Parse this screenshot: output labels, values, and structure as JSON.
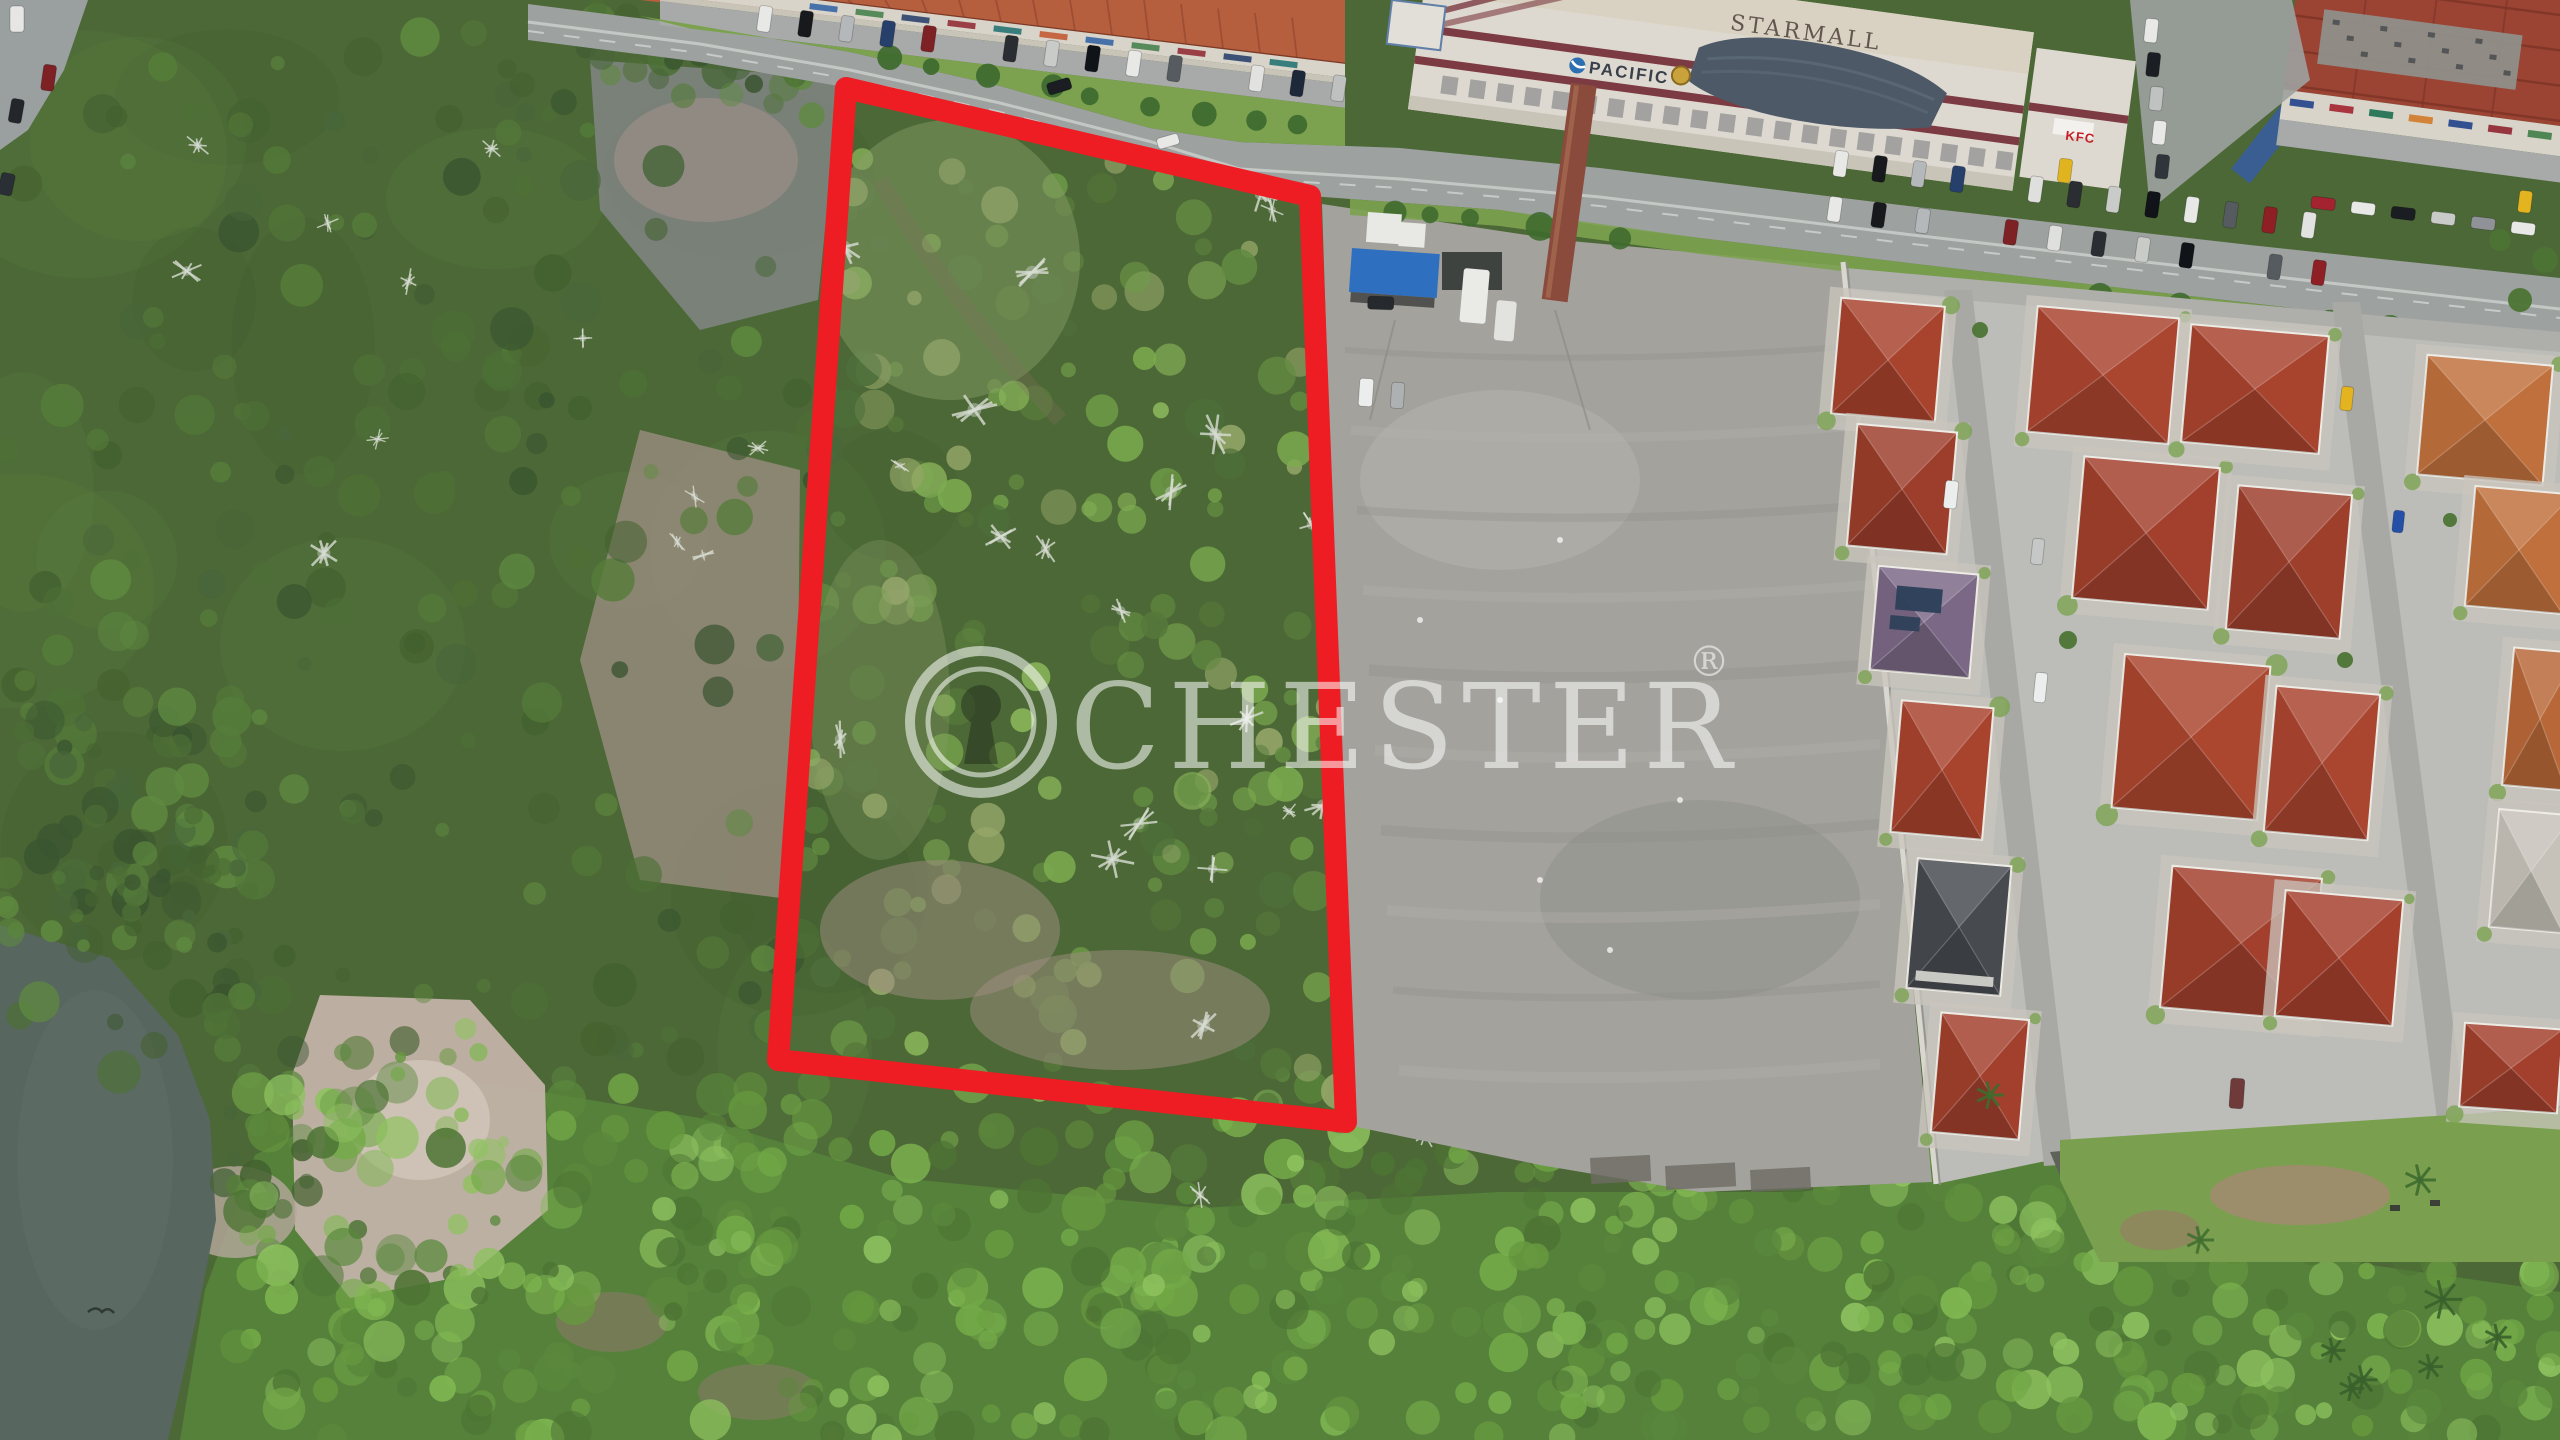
{
  "meta": {
    "title": "aerial-drone-land-parcel-photo",
    "canvas": {
      "width": 2560,
      "height": 1440
    }
  },
  "watermark": {
    "brand": "CHESTER",
    "registered_mark": "®",
    "logo": "keyhole-icon",
    "color": "#ffffff",
    "opacity": 0.55
  },
  "signage": {
    "mall_roof_sign": "STARMALL",
    "mall_facade_sign": "PACIFIC",
    "fastfood_sign": "KFC"
  },
  "boundary_overlay": {
    "color": "#ee1d23",
    "stroke_width": 22,
    "points": "846,88 1310,196 1346,1122 778,1060"
  },
  "palette": {
    "base_forest": "#4c6836",
    "road": "#9da1a0",
    "road_line": "#d2d5d2",
    "guardrail": "#c9ccc9",
    "pavement": "#9aa09f",
    "lot": "#a3a29d",
    "lot_light": "#b5b3ad",
    "lot_dark": "#908f89",
    "shop_roof": "#b65f3f",
    "shop_facade": "#d9d4c9",
    "walkway": "#c9c4b8",
    "parking": "#a7aaa9",
    "grass": "#7ca24f",
    "mall_white": "#ded9d0",
    "mall_cream": "#d9d2c2",
    "maroon": "#7c3b42",
    "canopy": "#4d5966",
    "brick": "#8a4a3c",
    "red_roof_block": "#9c4434",
    "estate_ground": "#bcbdb8",
    "street": "#a8a9a5",
    "asphalt_dark": "#5f6259",
    "wall": "#d9d7d0",
    "water": "#57665e",
    "pad": "#c9c6bd"
  },
  "scene": {
    "tree_palettes": {
      "dark": [
        "#3a5530",
        "#43612f",
        "#4d7036",
        "#557c3a",
        "#5f8a40",
        "#48663a"
      ],
      "bright": [
        "#4d7434",
        "#5a883c",
        "#67993f",
        "#74aa48",
        "#81b852",
        "#8ec25f"
      ],
      "parcel": [
        "#56793b",
        "#628b41",
        "#6f9d48",
        "#7cab4f",
        "#8ab65a",
        "#4d6e3a",
        "#97a86a"
      ]
    },
    "zones": [
      {
        "name": "rock-clearing-upper",
        "type": "poly",
        "points": "590,60 840,78 818,300 700,330 600,210",
        "fill": "#85878a",
        "opacity": 0.8
      },
      {
        "name": "rock-tint",
        "type": "ellipse",
        "cx": 706,
        "cy": 160,
        "rx": 92,
        "ry": 62,
        "fill": "#a5918a",
        "opacity": 0.55
      },
      {
        "name": "red-soil-clearing",
        "type": "poly",
        "points": "640,430 800,470 796,900 640,880 580,660",
        "fill": "#a5928a",
        "opacity": 0.7
      },
      {
        "name": "bottom-forest",
        "type": "poly",
        "points": "180,1440 205,1290 255,1155 420,1072 700,1118 900,1178 1200,1208 1500,1192 1800,1192 2050,1158 2200,1212 2350,1262 2560,1292 2560,1440",
        "fill": "#55813a",
        "opacity": 1
      },
      {
        "name": "pink-soil-clearing",
        "type": "poly",
        "points": "320,995 470,1000 545,1085 548,1210 470,1275 350,1298 295,1230 292,1075",
        "fill": "#c2b2a8",
        "opacity": 0.95
      },
      {
        "name": "pink-soil-light",
        "type": "ellipse",
        "cx": 420,
        "cy": 1120,
        "rx": 70,
        "ry": 60,
        "fill": "#d2c6bc",
        "opacity": 0.8
      },
      {
        "name": "pink-soil-secondary",
        "type": "ellipse",
        "cx": 235,
        "cy": 1212,
        "rx": 62,
        "ry": 46,
        "fill": "#b7a79d",
        "opacity": 0.8
      },
      {
        "name": "brown-patch-1",
        "type": "ellipse",
        "cx": 612,
        "cy": 1322,
        "rx": 56,
        "ry": 30,
        "fill": "#8b7a68",
        "opacity": 0.6
      },
      {
        "name": "brown-patch-2",
        "type": "ellipse",
        "cx": 758,
        "cy": 1392,
        "rx": 60,
        "ry": 28,
        "fill": "#8b7a68",
        "opacity": 0.55
      },
      {
        "name": "river",
        "type": "poly",
        "points": "0,925 110,958 178,1035 210,1120 216,1220 196,1320 168,1440 0,1440",
        "fill": "#57665e",
        "opacity": 1
      },
      {
        "name": "river-sheen",
        "type": "ellipse",
        "cx": 95,
        "cy": 1160,
        "rx": 78,
        "ry": 170,
        "fill": "#5f6e66",
        "opacity": 0.5
      }
    ],
    "scatter": [
      {
        "rect": [
          0,
          0,
          830,
          1080
        ],
        "count": 240,
        "palette": "dark",
        "rmin": 7,
        "rmax": 22,
        "avoid": true
      },
      {
        "rect": [
          500,
          0,
          330,
          120
        ],
        "count": 40,
        "palette": "dark",
        "rmin": 6,
        "rmax": 16
      },
      {
        "rect": [
          0,
          680,
          260,
          260
        ],
        "count": 60,
        "palette": "dark",
        "rmin": 7,
        "rmax": 20
      },
      {
        "rect": [
          40,
          866,
          220,
          80
        ],
        "count": 22,
        "palette": "dark",
        "rmin": 6,
        "rmax": 14
      },
      {
        "rect": [
          212,
          950,
          100,
          340
        ],
        "count": 30,
        "palette": "dark",
        "rmin": 7,
        "rmax": 16
      },
      {
        "rect": [
          300,
          1000,
          250,
          290
        ],
        "count": 14,
        "palette": "bright",
        "rmin": 5,
        "rmax": 11
      },
      {
        "rect": [
          230,
          1080,
          1120,
          360
        ],
        "count": 300,
        "palette": "bright",
        "rmin": 8,
        "rmax": 22
      },
      {
        "rect": [
          1350,
          1150,
          710,
          290
        ],
        "count": 160,
        "palette": "bright",
        "rmin": 8,
        "rmax": 20
      },
      {
        "rect": [
          2060,
          1250,
          500,
          190
        ],
        "count": 90,
        "palette": "bright",
        "rmin": 8,
        "rmax": 20
      },
      {
        "rect": [
          800,
          95,
          545,
          1030
        ],
        "count": 230,
        "palette": "parcel",
        "rmin": 7,
        "rmax": 20,
        "clip": true
      }
    ],
    "parcel_patches": [
      {
        "type": "ellipse",
        "cx": 950,
        "cy": 260,
        "rx": 130,
        "ry": 140,
        "fill": "#8aa06a",
        "opacity": 0.45
      },
      {
        "type": "ellipse",
        "cx": 880,
        "cy": 700,
        "rx": 70,
        "ry": 160,
        "fill": "#8aa06a",
        "opacity": 0.3
      },
      {
        "type": "ellipse",
        "cx": 940,
        "cy": 930,
        "rx": 120,
        "ry": 70,
        "fill": "#a08d82",
        "opacity": 0.5
      },
      {
        "type": "ellipse",
        "cx": 1120,
        "cy": 1010,
        "rx": 150,
        "ry": 60,
        "fill": "#a08d82",
        "opacity": 0.5
      }
    ],
    "dead_trees": {
      "parcel": 20,
      "left": 12,
      "extra": [
        [
          1695,
          1180
        ],
        [
          1200,
          1195
        ],
        [
          1425,
          1135
        ]
      ]
    },
    "houses": [
      [
        1836,
        302,
        104,
        116,
        5,
        "#a8432e",
        ""
      ],
      [
        1852,
        428,
        100,
        122,
        5,
        "#9c3e2b",
        ""
      ],
      [
        1874,
        570,
        100,
        104,
        5,
        "#7b6886",
        "solar"
      ],
      [
        1896,
        704,
        92,
        132,
        5,
        "#a8432e",
        ""
      ],
      [
        1912,
        862,
        94,
        130,
        5,
        "#474b50",
        "dark"
      ],
      [
        1936,
        1016,
        88,
        120,
        5,
        "#a2402d",
        ""
      ],
      [
        2032,
        312,
        142,
        126,
        5,
        "#aa4530",
        ""
      ],
      [
        2078,
        462,
        136,
        142,
        5,
        "#a2402d",
        ""
      ],
      [
        2118,
        660,
        146,
        154,
        5,
        "#ab462f",
        ""
      ],
      [
        2166,
        872,
        150,
        142,
        5,
        "#a2402d",
        ""
      ],
      [
        2186,
        330,
        138,
        118,
        5,
        "#a8432e",
        ""
      ],
      [
        2232,
        490,
        114,
        144,
        5,
        "#9e3f2c",
        ""
      ],
      [
        2270,
        690,
        104,
        146,
        5,
        "#aa4530",
        ""
      ],
      [
        2280,
        895,
        118,
        126,
        5,
        "#a5402d",
        ""
      ],
      [
        2422,
        360,
        126,
        120,
        5,
        "#c0703c",
        ""
      ],
      [
        2470,
        490,
        98,
        120,
        5,
        "#c0703c",
        ""
      ],
      [
        2508,
        650,
        64,
        138,
        5,
        "#b86838",
        ""
      ],
      [
        2494,
        812,
        74,
        118,
        5,
        "#c6c2b9",
        ""
      ],
      [
        2462,
        1026,
        98,
        84,
        4,
        "#a2402d",
        ""
      ]
    ],
    "structures": {
      "blue_stall": {
        "x": 1352,
        "y": 248,
        "w": 88,
        "h": 44,
        "rot": 4,
        "fill": "#2f6fc0"
      },
      "tents": [
        [
          1368,
          212,
          34,
          30
        ],
        [
          1400,
          222,
          26,
          24
        ]
      ],
      "shade_net": {
        "x": 1442,
        "y": 252,
        "w": 60,
        "h": 38,
        "fill": "#2e3330"
      },
      "lorry": [
        1464,
        268,
        26,
        54,
        5,
        "#eaeae7"
      ],
      "truck": [
        1497,
        300,
        20,
        40,
        5,
        "#e2e3df"
      ],
      "mall_annex": {
        "x": 1392,
        "y": 0,
        "w": 54,
        "h": 44,
        "fill": "#e2dfd8",
        "trim": "#5f7fa8"
      },
      "blue_awning": {
        "cx": 2275,
        "cy": 132,
        "w": 24,
        "h": 112,
        "rot": 38,
        "fill": "#3b5e92"
      }
    },
    "car_colors": [
      "#e8e8e6",
      "#17191d",
      "#b5b8ba",
      "#27406b",
      "#7e2125",
      "#dfe0de",
      "#2a2d31",
      "#c9cbc9",
      "#101318",
      "#e8e8e6",
      "#565b60",
      "#8e1f24",
      "#e2e3e1",
      "#1d2838",
      "#bfc1c0",
      "#e8e8e6"
    ],
    "vehicle_rows": [
      {
        "x0": 760,
        "x1": 1338,
        "step": 41,
        "base_x": 850,
        "base_y": 16,
        "slope": 0.121,
        "w": 13,
        "h": 26,
        "rot": 8,
        "skip": [
          5,
          11
        ]
      },
      {
        "x0": 1836,
        "x1": 2330,
        "step": 39,
        "base_x": 1836,
        "base_y": 150,
        "slope": 0.131,
        "w": 13,
        "h": 26,
        "rot": 8,
        "skip": [
          4
        ]
      },
      {
        "x0": 1830,
        "x1": 2332,
        "step": 44,
        "base_x": 1830,
        "base_y": 196,
        "slope": 0.131,
        "w": 13,
        "h": 25,
        "rot": 8,
        "skip": [
          3,
          9
        ]
      }
    ],
    "vehicles": [
      [
        10,
        6,
        14,
        26,
        0,
        "#e6e7e5"
      ],
      [
        44,
        64,
        13,
        26,
        8,
        "#7e2125"
      ],
      [
        12,
        98,
        13,
        24,
        10,
        "#23262b"
      ],
      [
        2,
        172,
        14,
        22,
        12,
        "#2a2f35"
      ],
      [
        1046,
        84,
        24,
        12,
        -17,
        "#1a1d22"
      ],
      [
        1156,
        139,
        22,
        11,
        -16,
        "#e8e9e7"
      ],
      [
        2146,
        18,
        13,
        24,
        6,
        "#e8e8e6"
      ],
      [
        2148,
        52,
        13,
        24,
        6,
        "#1b1e23"
      ],
      [
        2151,
        86,
        13,
        24,
        6,
        "#c0c2c1"
      ],
      [
        2154,
        120,
        13,
        24,
        6,
        "#e8e8e6"
      ],
      [
        2157,
        154,
        13,
        24,
        6,
        "#30353b"
      ],
      [
        2312,
        196,
        24,
        12,
        7,
        "#a32430"
      ],
      [
        2352,
        201,
        24,
        12,
        7,
        "#e8e8e6"
      ],
      [
        2392,
        206,
        24,
        12,
        7,
        "#1a1d22"
      ],
      [
        2432,
        211,
        24,
        12,
        7,
        "#c9cbc9"
      ],
      [
        2472,
        216,
        24,
        12,
        7,
        "#8f9296"
      ],
      [
        2512,
        221,
        24,
        12,
        7,
        "#e8e8e6"
      ],
      [
        2520,
        190,
        13,
        22,
        7,
        "#e3b320"
      ],
      [
        1360,
        378,
        14,
        28,
        4,
        "#eceded"
      ],
      [
        1392,
        382,
        13,
        26,
        4,
        "#aeb1b2"
      ],
      [
        1368,
        296,
        26,
        13,
        2,
        "#26292e"
      ],
      [
        2342,
        386,
        12,
        24,
        6,
        "#e3b320"
      ],
      [
        2394,
        510,
        11,
        22,
        6,
        "#2450a8"
      ],
      [
        1946,
        480,
        13,
        28,
        6,
        "#eceded"
      ],
      [
        2033,
        538,
        12,
        26,
        6,
        "#c6c8c7"
      ],
      [
        2036,
        672,
        12,
        30,
        6,
        "#eceded"
      ],
      [
        2231,
        1078,
        14,
        30,
        4,
        "#6e3a3a"
      ],
      [
        2060,
        158,
        13,
        24,
        7,
        "#e0b41f"
      ]
    ],
    "facade_sign_colors": [
      "#2e5fa3",
      "#3f7d46",
      "#203a66",
      "#8f2430",
      "#1b6f6f",
      "#c2542b",
      "#2e5fa3",
      "#3f7d46",
      "#8f2430",
      "#203a66",
      "#1b6f6f"
    ],
    "bird": {
      "x": 100,
      "y": 1312,
      "color": "#2f3a33"
    }
  }
}
